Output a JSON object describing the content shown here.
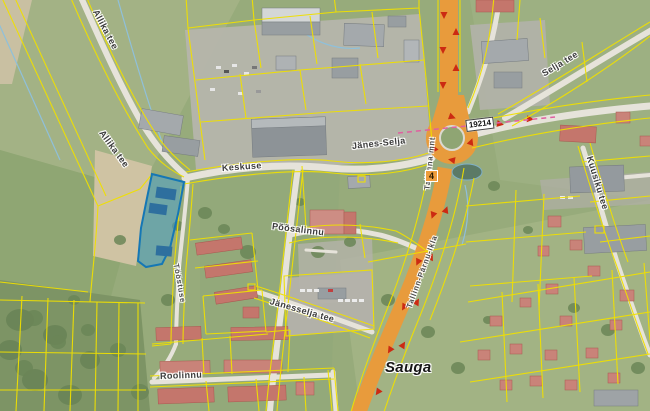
{
  "map": {
    "place": "Sauga",
    "labels": [
      {
        "text": "Allika tee"
      },
      {
        "text": "Allika tee"
      },
      {
        "text": "Keskuse"
      },
      {
        "text": "Jänes-Selja"
      },
      {
        "text": "Selja tee"
      },
      {
        "text": "Kuusiku tee"
      },
      {
        "text": "Põõsalinnu"
      },
      {
        "text": "Jänesselja tee"
      },
      {
        "text": "Roolinnu"
      },
      {
        "text": "Tööstuse"
      },
      {
        "text": "Tallinna mnt"
      },
      {
        "text": "Tallinn-Pärnu-Ikla"
      },
      {
        "text": "Sauga"
      }
    ],
    "badges": [
      {
        "number": "19214"
      },
      {
        "number": "4"
      }
    ],
    "colors": {
      "cadastral_line": "#f0e000",
      "selected_parcel_fill": "#3c96d2",
      "selected_parcel_border": "#1577b5",
      "highway": "#e89b3c",
      "traffic_arrow": "#cc2a12",
      "municipal_boundary": "#e060a0",
      "minor_road": "#e6e3da",
      "label_text": "#3b3b3b"
    }
  }
}
